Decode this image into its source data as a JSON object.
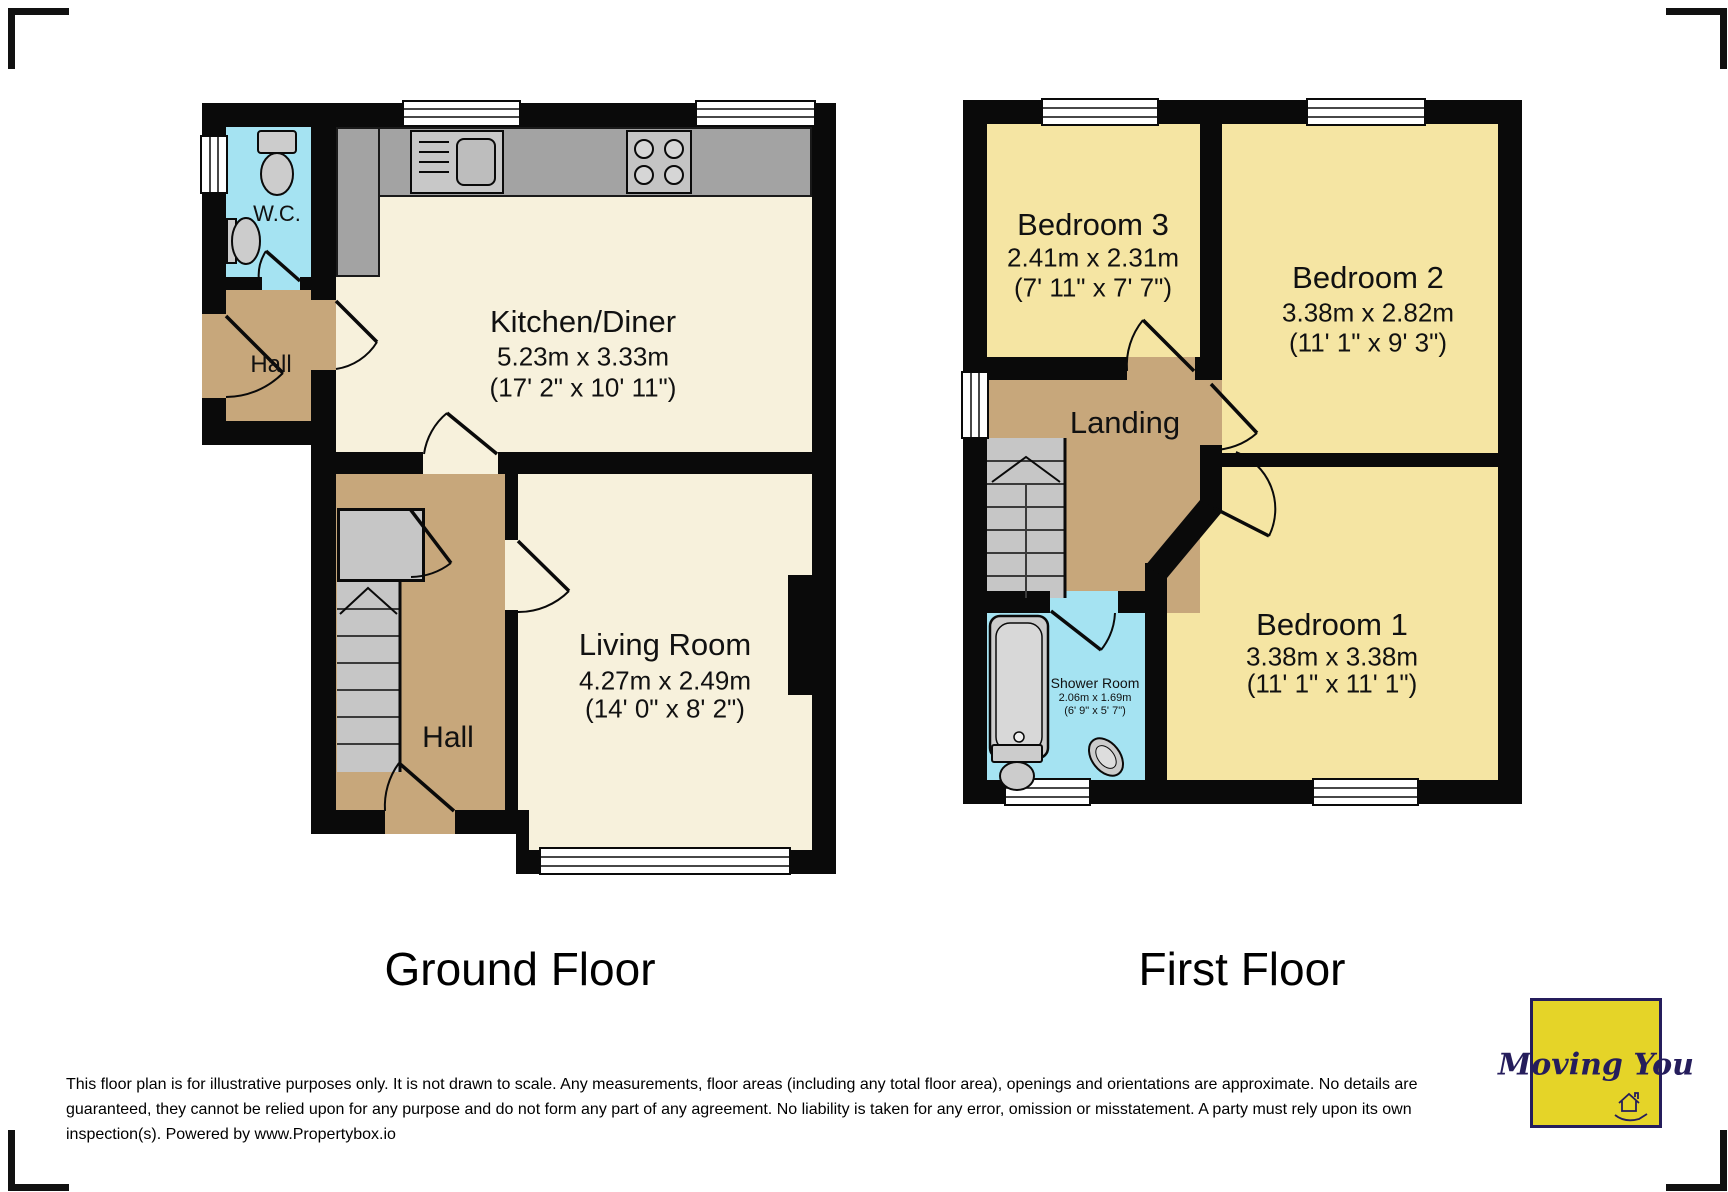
{
  "floors": [
    {
      "title": "Ground Floor",
      "rooms": {
        "wc": {
          "name": "W.C."
        },
        "hall_upper": {
          "name": "Hall"
        },
        "kitchen": {
          "name": "Kitchen/Diner",
          "dims_metric": "5.23m x 3.33m",
          "dims_imperial": "(17' 2\" x 10' 11\")"
        },
        "living": {
          "name": "Living Room",
          "dims_metric": "4.27m x 2.49m",
          "dims_imperial": "(14' 0\" x 8' 2\")"
        },
        "hall_lower": {
          "name": "Hall"
        }
      }
    },
    {
      "title": "First Floor",
      "rooms": {
        "bedroom3": {
          "name": "Bedroom 3",
          "dims_metric": "2.41m x 2.31m",
          "dims_imperial": "(7' 11\" x 7' 7\")"
        },
        "bedroom2": {
          "name": "Bedroom 2",
          "dims_metric": "3.38m x 2.82m",
          "dims_imperial": "(11' 1\" x 9' 3\")"
        },
        "landing": {
          "name": "Landing"
        },
        "shower": {
          "name": "Shower Room",
          "dims_metric": "2.06m x 1.69m",
          "dims_imperial": "(6' 9\" x 5' 7\")"
        },
        "bedroom1": {
          "name": "Bedroom 1",
          "dims_metric": "3.38m x 3.38m",
          "dims_imperial": "(11' 1\" x 11' 1\")"
        }
      }
    }
  ],
  "disclaimer": {
    "lines": [
      "This floor plan is for illustrative purposes only. It is not drawn to scale. Any measurements, floor areas (including any total floor area), openings and orientations are approximate. No details are",
      "guaranteed, they cannot be relied upon for any purpose and do not form any part of any agreement. No liability is taken for any error, omission or misstatement. A party must rely upon its own",
      "inspection(s). Powered by www.Propertybox.io"
    ]
  },
  "logo": {
    "text": "Moving You"
  },
  "colors": {
    "floor_cream": "#f7f1dc",
    "floor_yellow": "#f5e5a3",
    "floor_tan": "#c7a77b",
    "floor_cyan": "#a5e3f2",
    "wall": "#0a0a0a",
    "counter_gray": "#a3a3a3",
    "stairs_gray": "#c6c6c6",
    "logo_yellow": "#e5d428",
    "logo_navy": "#251d5c"
  }
}
